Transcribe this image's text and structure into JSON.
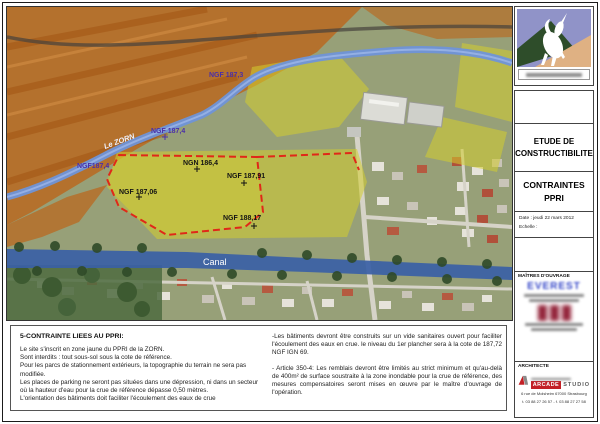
{
  "map": {
    "labels": {
      "ngf_187_3": "NGF 187,3",
      "le_zorn": "Le ZORN",
      "ngf_187_4": "NGF 187,4",
      "ngf_187_4b": "NGF187,4",
      "ngn_186_4": "NGN 186,4",
      "ngf_187_91": "NGF 187,91",
      "ngf_187_06": "NGF 187,06",
      "ngf_188_17": "NGF 188,17",
      "canal": "Canal"
    },
    "colors": {
      "base": "#97a078",
      "orange_zone": "#bc6418",
      "orange_deep": "#9e4f0e",
      "yellow_zone": "#d4ce2e",
      "river": "#6f93d8",
      "canal": "#3a5fa6",
      "site_boundary_red": "#e02818",
      "label_purple": "#4b2fa8"
    }
  },
  "title_block": {
    "project_title_line1": "ETUDE DE",
    "project_title_line2": "CONSTRUCTIBILITE",
    "sheet_title_line1": "CONTRAINTES",
    "sheet_title_line2": "PPRI",
    "date_label": "Date : jeudi 22 mars 2012",
    "scale_label": "Echelle :",
    "owner_header": "MAÎTRES D'OUVRAGE",
    "owner_name": "EVEREST",
    "architect_header": "ARCHITECTE",
    "architect_name_red": "ARCADE",
    "architect_name_gray": "STUDIO",
    "architect_address": "6 rue de Molsheim 67000 Strasbourg",
    "architect_phone": "t. 03 88 27 26 57 - f. 03 88 27 27 58"
  },
  "notes": {
    "title": "5-CONTRAINTE LIEES AU PPRI:",
    "left": [
      "Le site s'inscrit en zone jaune du PPRI de la ZORN.",
      "Sont interdits : tout sous-sol sous la cote de référence.",
      "Pour les parcs de stationnement extérieurs, la topographie du terrain ne sera pas modifiée.",
      "Les places de parking ne seront pas situées dans une dépression, ni dans un secteur où la hauteur d'eau pour la crue de référence dépasse 0,50 mètres.",
      "L'orientation des bâtiments doit faciliter l'écoulement des eaux de crue"
    ],
    "right": [
      "-Les bâtiments devront être construits sur un vide sanitaires ouvert pour faciliter l'écoulement des eaux en crue. le niveau du 1er plancher sera à la cote de 187,72 NGF IGN 69.",
      "- Article 350-4: Les remblais devront être limités au strict minimum et qu'au-delà de 400m² de surface soustraite à la zone inondable pour la crue de référence, des mesures compensatoires seront mises en œuvre par le maître d'ouvrage de l'opération."
    ]
  }
}
